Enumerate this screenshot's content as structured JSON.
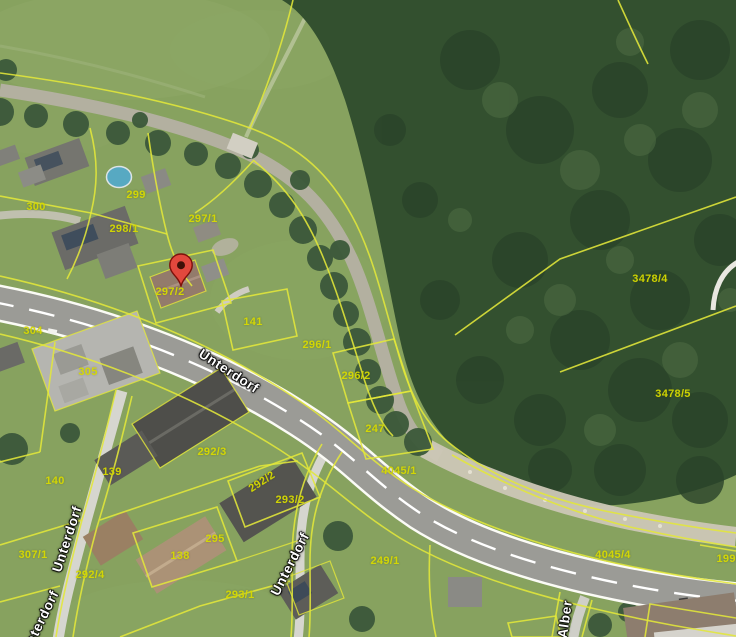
{
  "map": {
    "type": "aerial-cadastral-view",
    "colors": {
      "meadow": "#87a25f",
      "forest": "#33502f",
      "stream": "#b5b1a3",
      "gravel": "#ccc7b6",
      "road": "#9b9b96",
      "road_edge": "#fbfbf6",
      "parcel_line": "#e3e73a",
      "parcel_label": "#d6da00",
      "street_label": "#ffffff",
      "marker": "#e2483d"
    },
    "parcel_labels": [
      {
        "text": "300",
        "x": 36,
        "y": 207
      },
      {
        "text": "299",
        "x": 136,
        "y": 195
      },
      {
        "text": "298/1",
        "x": 124,
        "y": 229
      },
      {
        "text": "297/1",
        "x": 203,
        "y": 219
      },
      {
        "text": "297/2",
        "x": 170,
        "y": 292
      },
      {
        "text": "304",
        "x": 33,
        "y": 331
      },
      {
        "text": "305",
        "x": 88,
        "y": 372
      },
      {
        "text": "141",
        "x": 253,
        "y": 322
      },
      {
        "text": "296/1",
        "x": 317,
        "y": 345
      },
      {
        "text": "296/2",
        "x": 356,
        "y": 376
      },
      {
        "text": "247",
        "x": 375,
        "y": 429
      },
      {
        "text": "3478/4",
        "x": 650,
        "y": 279
      },
      {
        "text": "3478/5",
        "x": 673,
        "y": 394
      },
      {
        "text": "4045/1",
        "x": 399,
        "y": 471
      },
      {
        "text": "4045/4",
        "x": 613,
        "y": 555
      },
      {
        "text": "199/1",
        "x": 731,
        "y": 559
      },
      {
        "text": "292/3",
        "x": 212,
        "y": 452
      },
      {
        "text": "139",
        "x": 112,
        "y": 472
      },
      {
        "text": "140",
        "x": 55,
        "y": 481
      },
      {
        "text": "292/2",
        "x": 262,
        "y": 482,
        "rotation": -33
      },
      {
        "text": "293/2",
        "x": 290,
        "y": 500
      },
      {
        "text": "295",
        "x": 215,
        "y": 539
      },
      {
        "text": "138",
        "x": 180,
        "y": 556
      },
      {
        "text": "307/1",
        "x": 33,
        "y": 555
      },
      {
        "text": "292/4",
        "x": 90,
        "y": 575
      },
      {
        "text": "293/1",
        "x": 240,
        "y": 595
      },
      {
        "text": "249/1",
        "x": 385,
        "y": 561
      }
    ],
    "street_labels": [
      {
        "text": "Unterdorf",
        "x": 229,
        "y": 371,
        "rotation": 33
      },
      {
        "text": "Unterdorf",
        "x": 67,
        "y": 539,
        "rotation": -72
      },
      {
        "text": "Unterdorf",
        "x": 290,
        "y": 564,
        "rotation": -63
      },
      {
        "text": "Unterdorf",
        "x": 40,
        "y": 622,
        "rotation": -64
      },
      {
        "text": "Alber",
        "x": 565,
        "y": 619,
        "rotation": -82
      }
    ],
    "marker": {
      "x": 181,
      "y": 287
    }
  }
}
